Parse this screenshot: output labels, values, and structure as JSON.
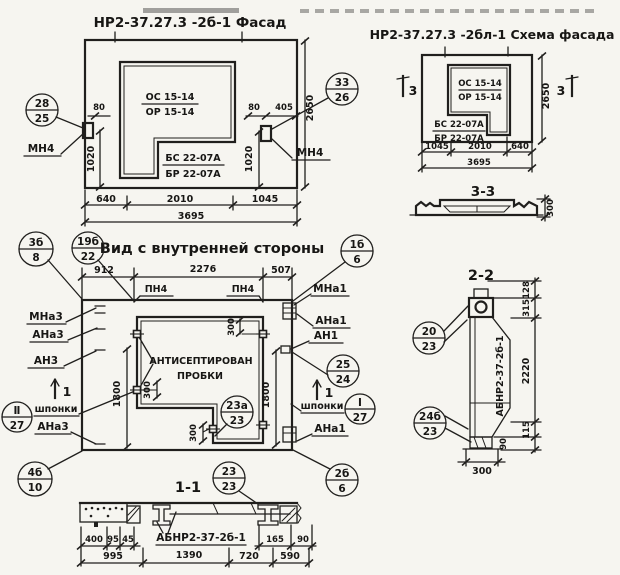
{
  "facade": {
    "title": "НР2-37.27.3 -2б-1 Фасад",
    "os": "ОС 15-14",
    "or": "ОР 15-14",
    "bs": "БС 22-07А",
    "br": "БР 22-07А",
    "mn4_left": "МН4",
    "mn4_right": "МН4",
    "badge_left": {
      "num": "28",
      "den": "25"
    },
    "badge_right": {
      "num": "33",
      "den": "26"
    },
    "d80l": "80",
    "d80r": "80",
    "d405": "405",
    "d1020l": "1020",
    "d1020r": "1020",
    "d2650": "2650",
    "d640": "640",
    "d2010": "2010",
    "d1045": "1045",
    "d3695": "3695"
  },
  "scheme": {
    "title": "НР2-37.27.3 -2бл-1 Схема фасада",
    "os": "ОС 15-14",
    "or": "ОР 15-14",
    "bs": "БС 22-07А",
    "br": "БР 22-07А",
    "mark_left": "3",
    "mark_right": "3",
    "d1045": "1045",
    "d2010": "2010",
    "d640": "640",
    "d3695": "3695",
    "d2650": "2650"
  },
  "s33": {
    "title": "3-3",
    "d300": "300"
  },
  "view": {
    "title": "Вид с внутренней стороны",
    "pn4_left": "ПН4",
    "pn4_right": "ПН4",
    "mna3": "МНа3",
    "ana3_top": "АНа3",
    "an3": "АН3",
    "shponki_left": "шпонки",
    "ana3_bot": "АНа3",
    "mna1": "МНа1",
    "ana1_top": "АНа1",
    "an1": "АН1",
    "shponki_right": "шпонки",
    "ana1_bot": "АНа1",
    "anti1": "АНТИСЕПТИРОВАН",
    "anti2": "ПРОБКИ",
    "mark_left": "1",
    "mark_right": "1",
    "d912": "912",
    "d2276": "2276",
    "d507": "507",
    "d1800l": "1800",
    "d1800r": "1800",
    "d300top": "300",
    "d300left": "300",
    "d300leg": "300",
    "b_3b8": {
      "num": "3б",
      "den": "8"
    },
    "b_19b22": {
      "num": "19б",
      "den": "22"
    },
    "b_1b6": {
      "num": "1б",
      "den": "6"
    },
    "b_4b10": {
      "num": "4б",
      "den": "10"
    },
    "b_II27": {
      "num": "Ⅱ",
      "den": "27"
    },
    "b_2524": {
      "num": "25",
      "den": "24"
    },
    "b_I27": {
      "num": "Ⅰ",
      "den": "27"
    },
    "b_23a23": {
      "num": "23а",
      "den": "23"
    },
    "b_2b6": {
      "num": "2б",
      "den": "6"
    }
  },
  "s22": {
    "title": "2-2",
    "label": "АБНР2-37-2б-1",
    "b_2023": {
      "num": "20",
      "den": "23"
    },
    "b_24b23": {
      "num": "24б",
      "den": "23"
    },
    "d128": "128",
    "d315": "315",
    "d2220": "2220",
    "d115": "115",
    "d90": "90",
    "d300": "300"
  },
  "s11": {
    "title": "1-1",
    "label": "АБНР2-37-2б-1",
    "b_2323": {
      "num": "23",
      "den": "23"
    },
    "d400": "400",
    "d95": "95",
    "d45": "45",
    "d165": "165",
    "d90": "90",
    "d995": "995",
    "d1390": "1390",
    "d720": "720",
    "d590": "590"
  }
}
